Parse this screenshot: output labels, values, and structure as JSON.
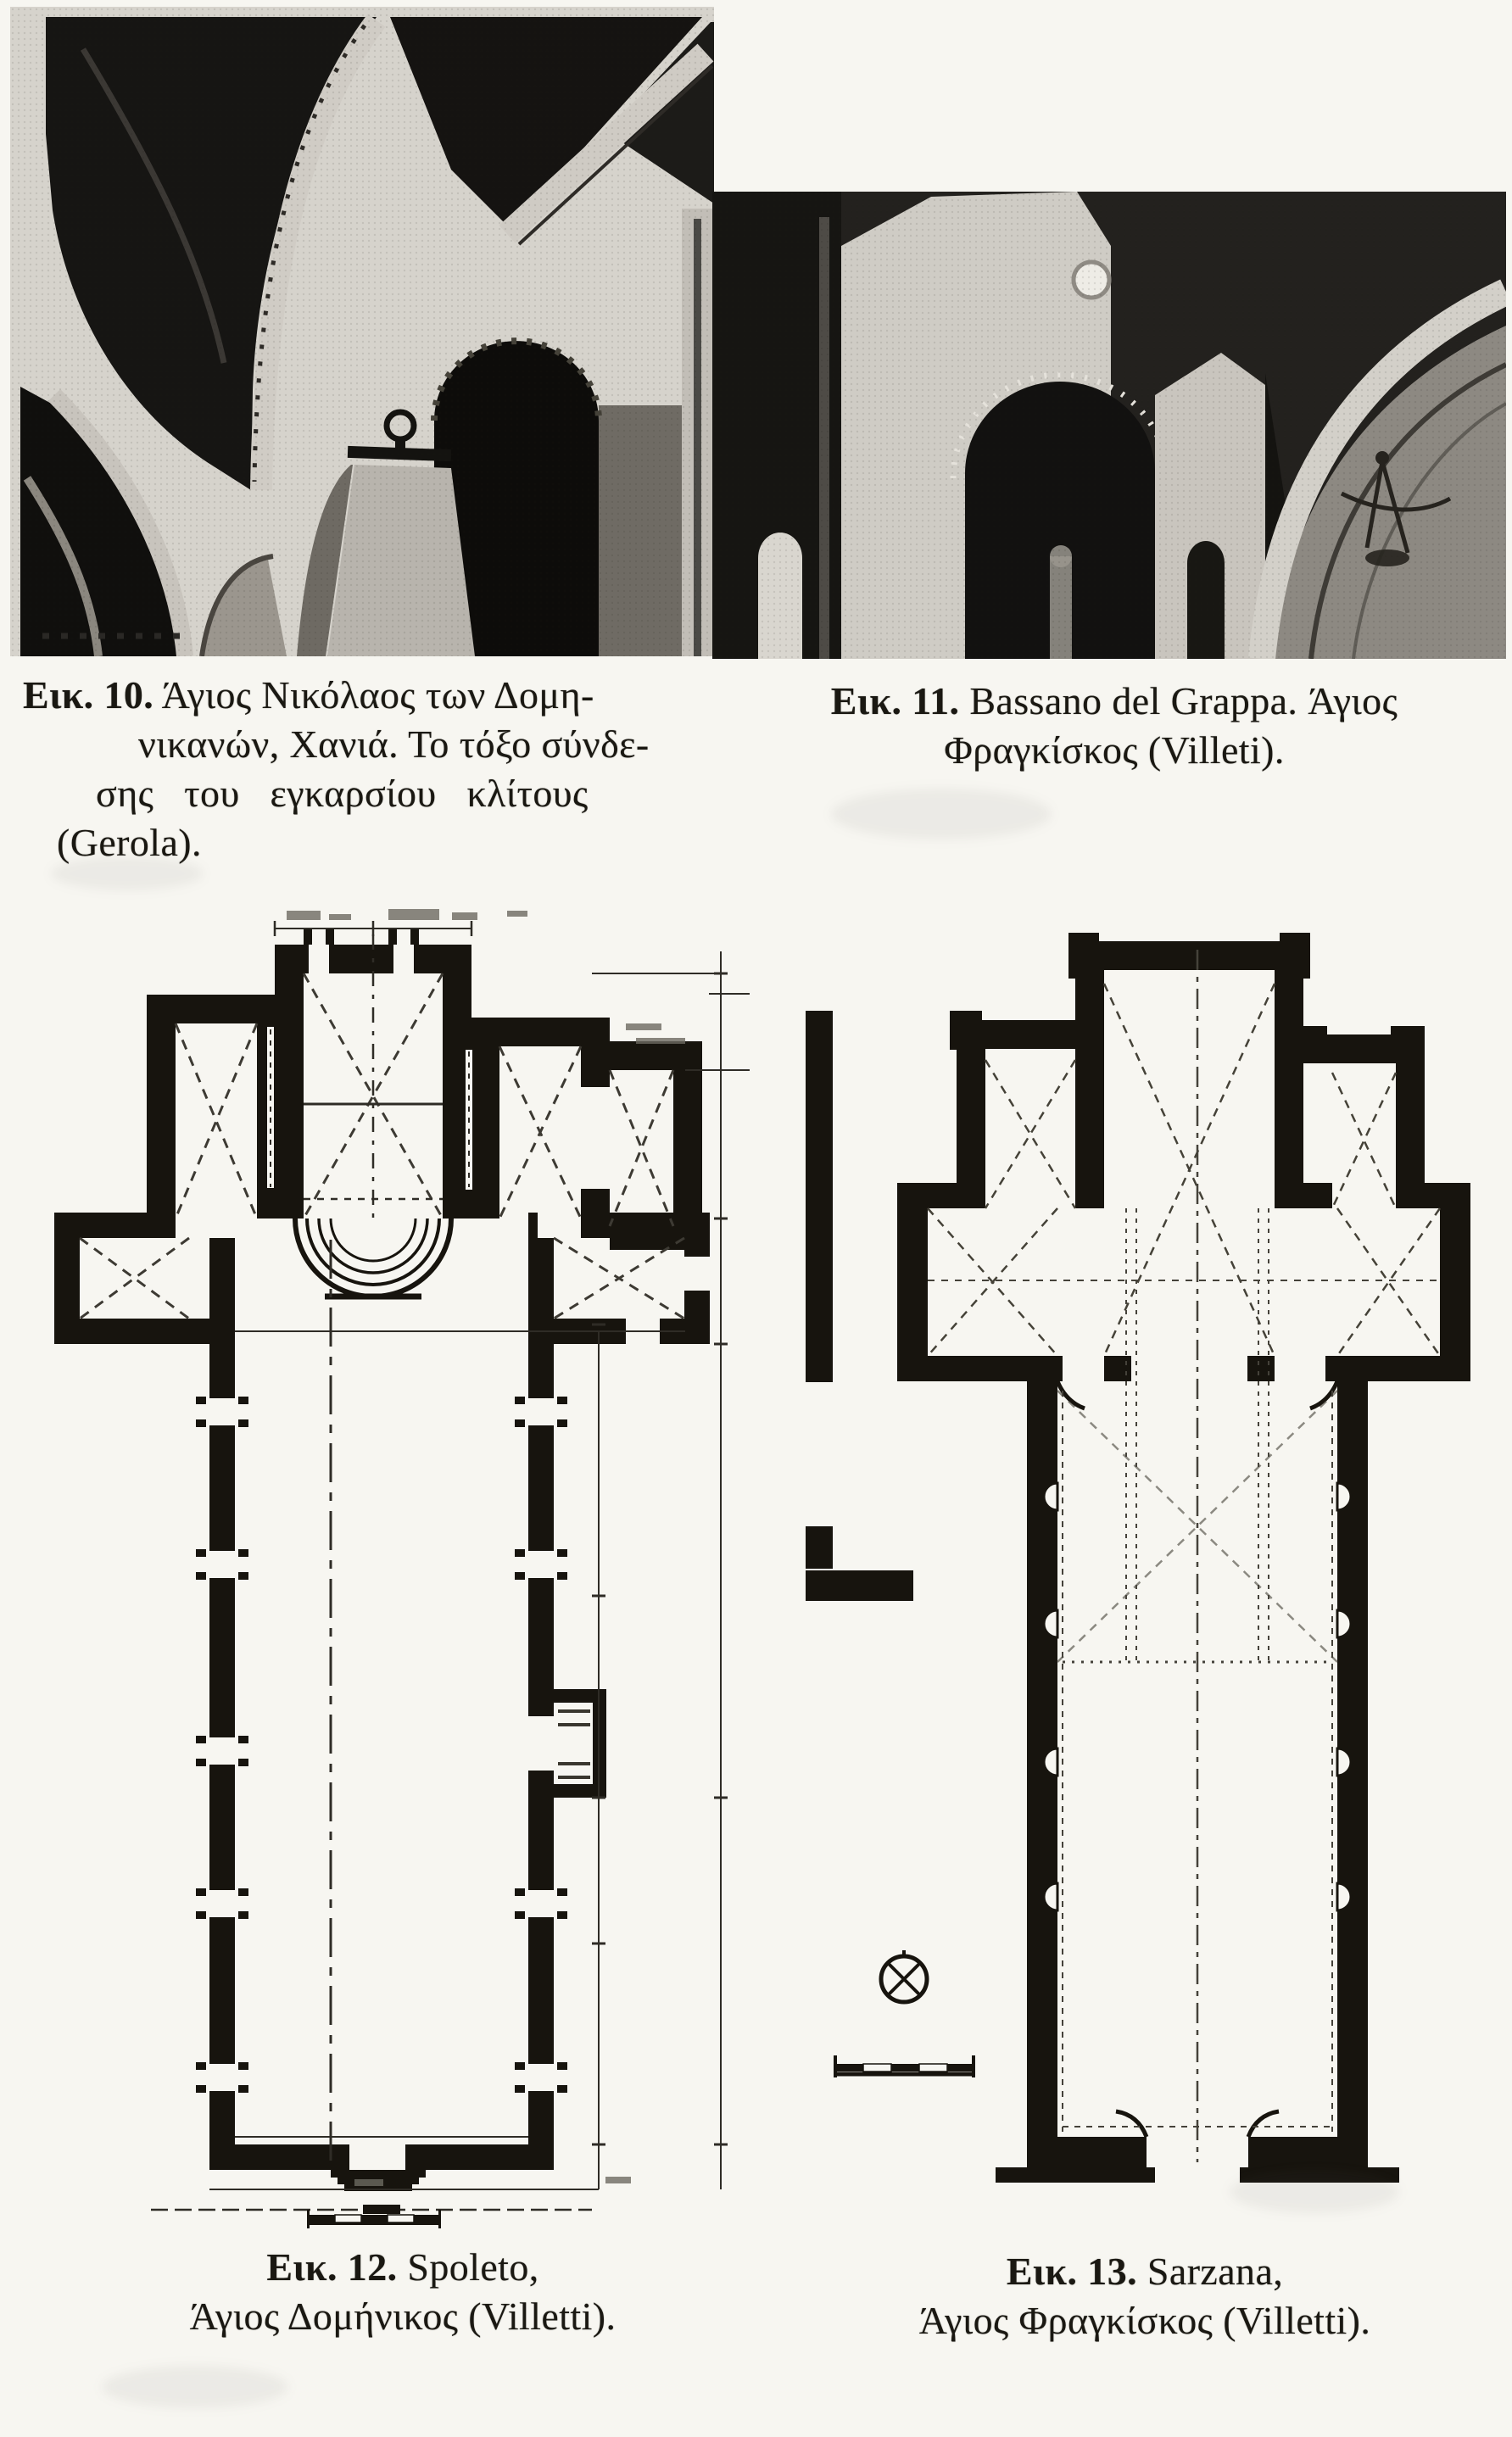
{
  "colors": {
    "paper": "#f7f6f1",
    "ink": "#1a1812",
    "plan_wall": "#17140e",
    "photo_dark": "#151311",
    "photo_light": "#d6d3cc"
  },
  "figures": [
    {
      "label": "Εικ. 10.",
      "caption_lines": [
        "Άγιος Νικόλαος των Δομη-",
        "νικανών, Χανιά. Το τόξο σύνδε-",
        "σης του εγκαρσίου κλίτους",
        "(Gerola)."
      ]
    },
    {
      "label": "Εικ. 11.",
      "caption_lines": [
        "Bassano del Grappa. Άγιος",
        "Φραγκίσκος (Villeti)."
      ]
    },
    {
      "label": "Εικ. 12.",
      "caption_lines": [
        "Spoleto,",
        "Άγιος Δομήνικος (Villetti)."
      ]
    },
    {
      "label": "Εικ. 13.",
      "caption_lines": [
        "Sarzana,",
        "Άγιος Φραγκίσκος (Villetti)."
      ]
    }
  ]
}
